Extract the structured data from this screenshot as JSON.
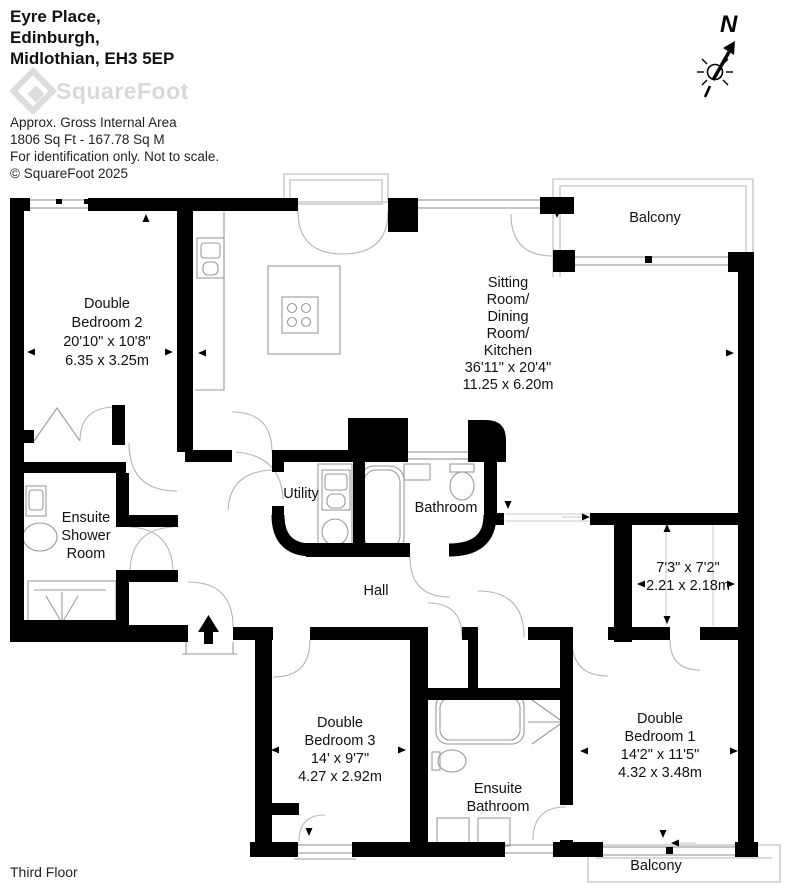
{
  "header": {
    "address_lines": [
      "Eyre Place,",
      "Edinburgh,",
      "Midlothian, EH3 5EP"
    ],
    "logo_text": "SquareFoot",
    "info_lines": [
      "Approx. Gross Internal Area",
      "1806 Sq Ft  -  167.78 Sq M",
      "For identification only. Not to scale.",
      "© SquareFoot 2025"
    ]
  },
  "compass": {
    "north_label": "N"
  },
  "floor_label": "Third Floor",
  "rooms": {
    "bedroom2": {
      "lines": [
        "Double",
        "Bedroom 2",
        "20'10\" x 10'8\"",
        "6.35 x 3.25m"
      ]
    },
    "sitting": {
      "lines": [
        "Sitting",
        "Room/",
        "Dining",
        "Room/",
        "Kitchen",
        "36'11\" x 20'4\"",
        "11.25 x 6.20m"
      ]
    },
    "balcony_top": {
      "label": "Balcony"
    },
    "ensuite_shower": {
      "lines": [
        "Ensuite",
        "Shower",
        "Room"
      ]
    },
    "utility": {
      "label": "Utility"
    },
    "bathroom": {
      "label": "Bathroom"
    },
    "hall": {
      "label": "Hall"
    },
    "store": {
      "lines": [
        "7'3\" x 7'2\"",
        "2.21 x 2.18m"
      ]
    },
    "bedroom3": {
      "lines": [
        "Double",
        "Bedroom 3",
        "14' x 9'7\"",
        "4.27 x 2.92m"
      ]
    },
    "ensuite_bathroom": {
      "lines": [
        "Ensuite",
        "Bathroom"
      ]
    },
    "bedroom1": {
      "lines": [
        "Double",
        "Bedroom 1",
        "14'2\" x 11'5\"",
        "4.32 x 3.48m"
      ]
    },
    "balcony_bottom": {
      "label": "Balcony"
    }
  },
  "colors": {
    "wall": "#000000",
    "fixture_line": "#9a9a9a",
    "balcony_line": "#c4c4c4",
    "logo_gray": "#d8d8d8",
    "text": "#1a1a1a"
  }
}
